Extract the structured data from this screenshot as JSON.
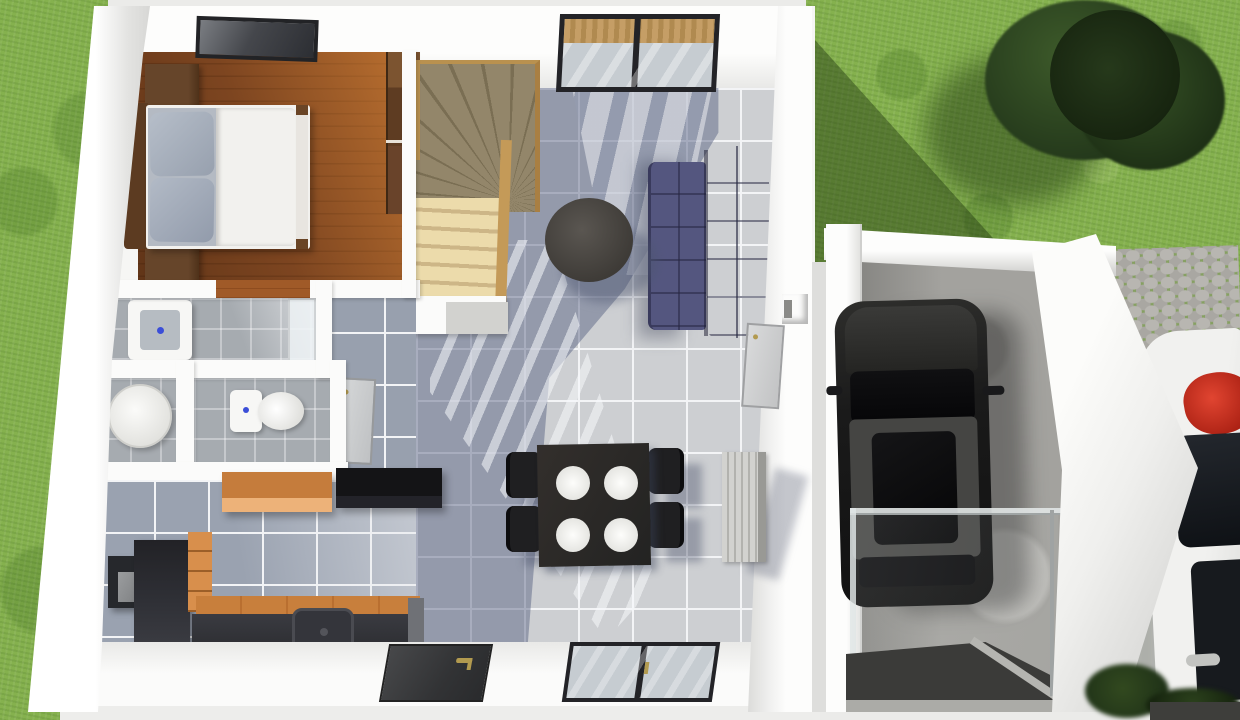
{
  "scene": {
    "type": "3d-rendered-top-down-floor-plan",
    "description": "Aerial 3D render of a small house ground floor with bedroom, stair, living-dining room, bathroom cluster, kitchen, attached garage with parked dark car, lawn, tree, stone path and a partially visible white car",
    "rooms": [
      "bedroom",
      "staircase",
      "living-dining-room",
      "bathroom",
      "laundry-wc",
      "wc",
      "hallway",
      "kitchen",
      "garage"
    ],
    "objects": [
      "double-bed",
      "pillows",
      "nightstand-top",
      "nightstand-bottom",
      "wardrobe",
      "skylight-window",
      "winder-staircase",
      "navy-sofa",
      "round-coffee-table",
      "dining-table-with-plates",
      "dining-chairs",
      "washbasin",
      "shower-screen",
      "washing-machine",
      "toilet",
      "interior-doors",
      "radiator",
      "wall-niche",
      "kitchen-counter-with-sink",
      "orange-wall-cabinet",
      "black-wall-cabinet",
      "fridge",
      "oven-box",
      "orange-drawer-unit",
      "appliance-boxes",
      "floor-glass-panel",
      "front-door",
      "south-window",
      "north-window",
      "garage-car",
      "glass-balustrade",
      "garage-platform",
      "white-car",
      "red-roof-item",
      "tree",
      "stone-path",
      "plants"
    ],
    "counts": {
      "dining_plates": 4,
      "dining_chairs": 4,
      "cars": 2,
      "sofa_sections": 2
    }
  },
  "palette": {
    "grass": "#85b14e",
    "grassShadow": "#3a5c22",
    "treeFoliage": "#2a4220",
    "wallWhite": "#fbfbfa",
    "wallShade": "#d8d8d5",
    "woodFloor": "#7d4520",
    "woodSun": "#c8833c",
    "woodFurniture": "#5f3e23",
    "bedLinen": "#f2f1ee",
    "pillowGray": "#a9b1be",
    "stairsWood": "#e2cf9f",
    "stairsShade": "#83765a",
    "tileLight": "#cdcfd2",
    "tileGrout": "#f3f4f6",
    "tileShadow": "#58617f",
    "bathTile": "#a6abb0",
    "sofaBlue": "#54567f",
    "tableBlack": "#2c2c2e",
    "chairBlack": "#1f1f21",
    "plateWhite": "#fafaf8",
    "cabinetOrange": "#edb279",
    "cabinetOrangeTop": "#c57c3c",
    "counterDark": "#2f3036",
    "counterWood": "#c87f3c",
    "applianceGlass": "#dbe6e7",
    "applianceBody": "#26282c",
    "fridgeDark": "#26262b",
    "doorCharcoal": "#3a3b3e",
    "handleBrass": "#b29a4f",
    "windowFrame": "#232327",
    "windowGlass": "#c6ccd1",
    "sanitaryWhite": "#f7f7f5",
    "accentBlue": "#3b4ed8",
    "radiatorGray": "#c6c6c2",
    "concreteFloor": "#a3a29e",
    "platformGray": "#3b3b39",
    "carBlack": "#1b1b1b",
    "carRoofGray": "#454543",
    "whiteCarBody": "#f1f1ef",
    "redAccent": "#cf3322",
    "stonePath": "#b8b6b1",
    "plantDark": "#203318",
    "groundLight": "#ebebe9",
    "glassRail": "#dfe4e4"
  }
}
